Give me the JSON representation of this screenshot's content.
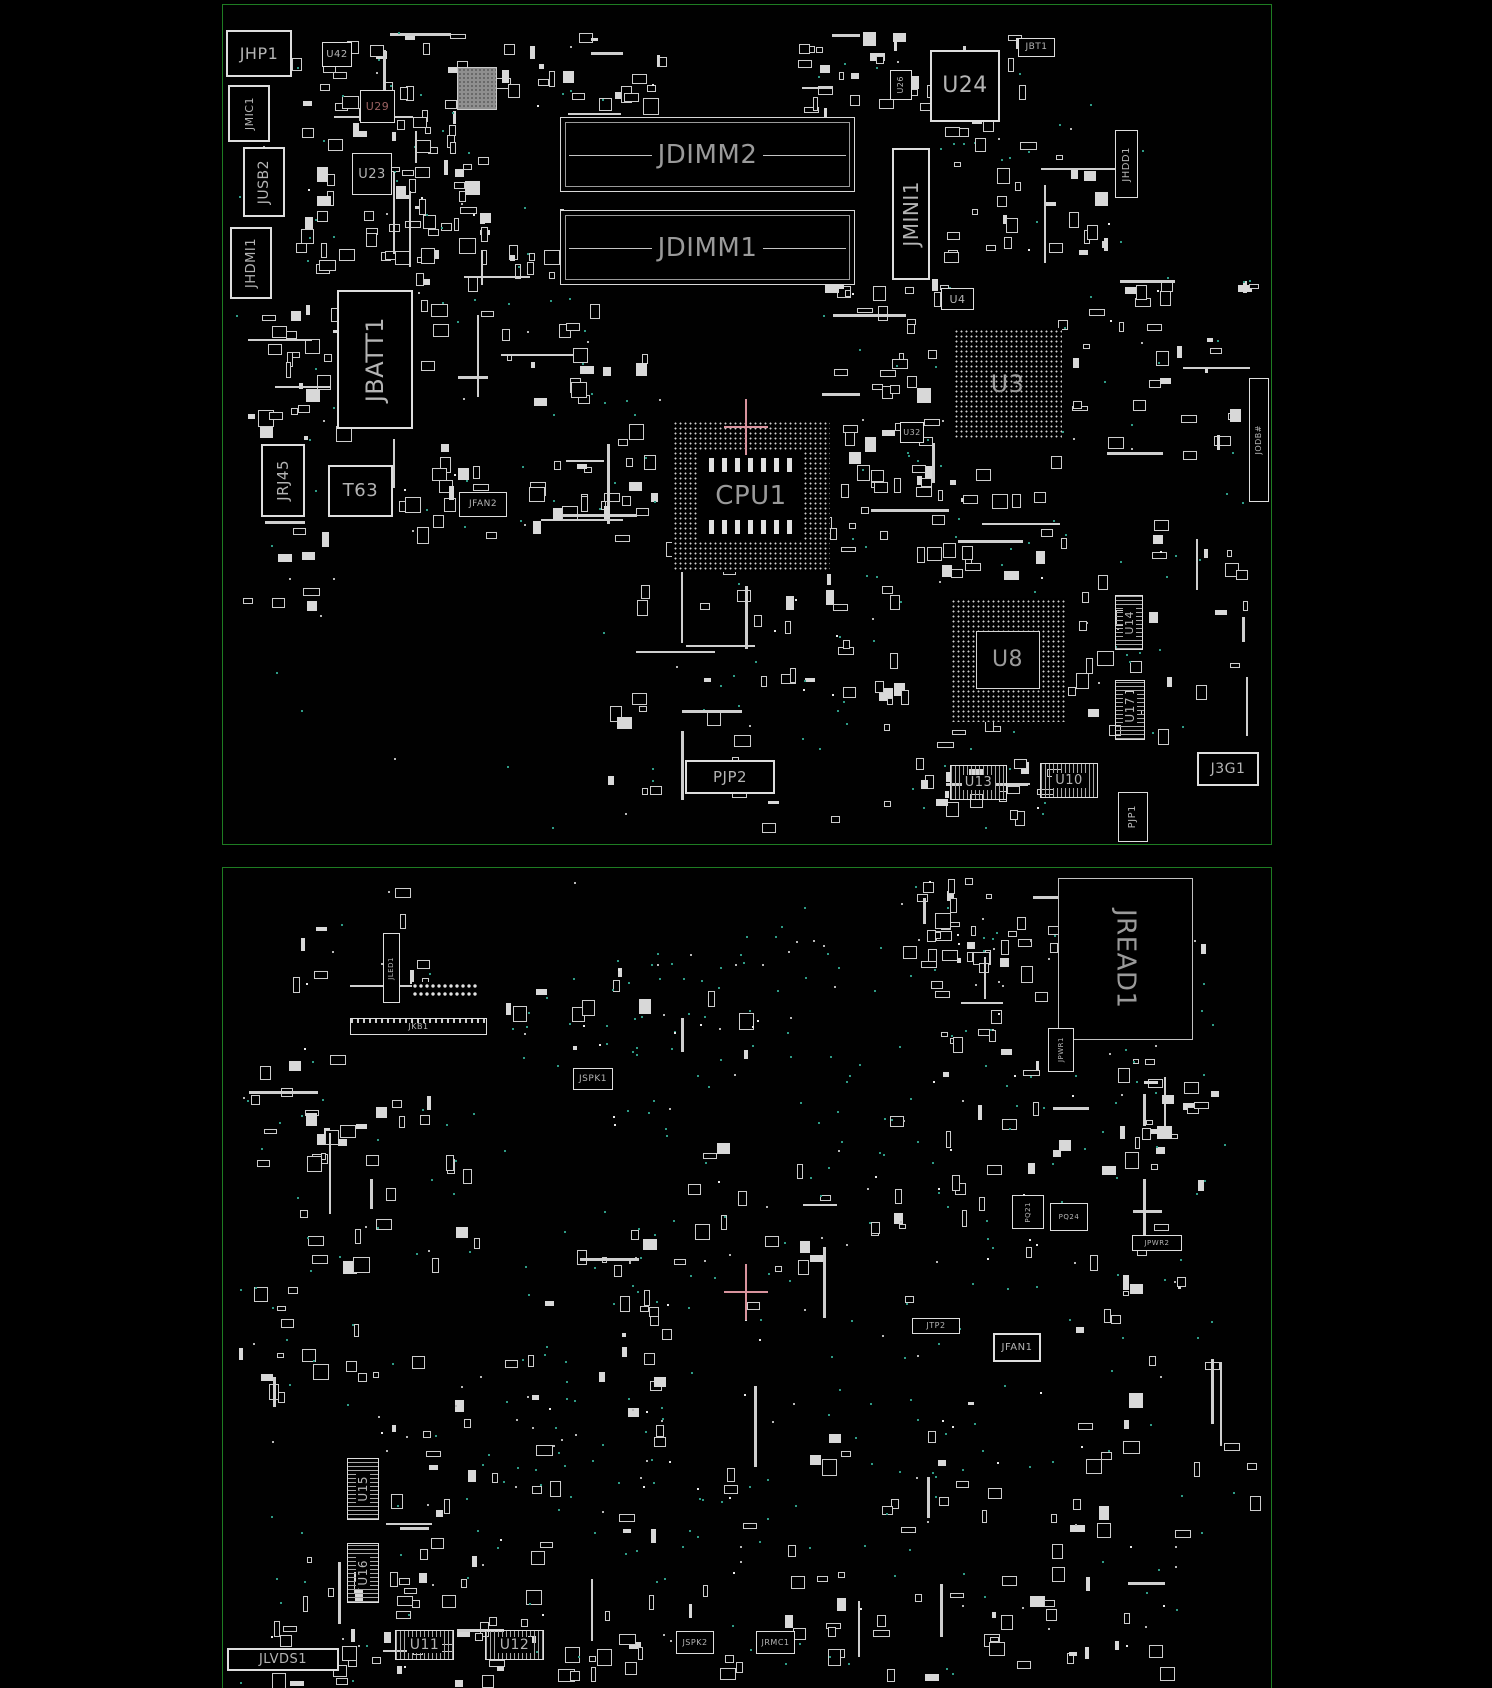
{
  "title": "Motherboard boardview - top and bottom side",
  "colors": {
    "background": "#000000",
    "board_border": "#1e7c22",
    "component_outline": "#dedede",
    "label": "#b4b4b4",
    "via_teal": "#2e9b86",
    "crosshair_pink": "#d8939d",
    "highlight_label_red": "#9b6262",
    "gray_chip_fill": "#8f8f8f"
  },
  "boards": {
    "top": {
      "name": "top-side-board"
    },
    "bottom": {
      "name": "bottom-side-board"
    }
  },
  "c": {
    "jhp1": {
      "label": "JHP1"
    },
    "jmic1": {
      "label": "JMIC1"
    },
    "jusb2": {
      "label": "JUSB2"
    },
    "jhdmi1": {
      "label": "JHDMI1"
    },
    "u42": {
      "label": "U42"
    },
    "u29": {
      "label": "U29"
    },
    "u23": {
      "label": "U23"
    },
    "u26": {
      "label": "U26"
    },
    "jbatt1": {
      "label": "JBATT1"
    },
    "jrj45": {
      "label": "JRJ45"
    },
    "t63": {
      "label": "T63"
    },
    "jfan2": {
      "label": "JFAN2"
    },
    "jdimm2": {
      "label": "JDIMM2"
    },
    "jdimm1": {
      "label": "JDIMM1"
    },
    "cpu1": {
      "label": "CPU1"
    },
    "u24": {
      "label": "U24"
    },
    "jbt1": {
      "label": "JBT1"
    },
    "jmini1": {
      "label": "JMINI1"
    },
    "u4": {
      "label": "U4"
    },
    "u3": {
      "label": "U3"
    },
    "u32": {
      "label": "U32"
    },
    "jhdd1": {
      "label": "JHDD1"
    },
    "jodb": {
      "label": "JODB#"
    },
    "u8": {
      "label": "U8"
    },
    "u14": {
      "label": "U14"
    },
    "u17": {
      "label": "U17"
    },
    "u13": {
      "label": "U13"
    },
    "u10": {
      "label": "U10"
    },
    "pjp2": {
      "label": "PJP2"
    },
    "j3g1": {
      "label": "J3G1"
    },
    "pjp1": {
      "label": "PJP1"
    },
    "jread1": {
      "label": "JREAD1"
    },
    "jled1": {
      "label": "JLED1"
    },
    "jkb1": {
      "label": "JKB1"
    },
    "jspk1": {
      "label": "JSPK1"
    },
    "jtp2": {
      "label": "JTP2"
    },
    "jfan1": {
      "label": "JFAN1"
    },
    "jpwr1": {
      "label": "JPWR1"
    },
    "jpwr2": {
      "label": "JPWR2"
    },
    "pq21": {
      "label": "PQ21"
    },
    "pq24": {
      "label": "PQ24"
    },
    "u15": {
      "label": "U15"
    },
    "u16": {
      "label": "U16"
    },
    "jlvds1": {
      "label": "JLVDS1"
    },
    "u11": {
      "label": "U11"
    },
    "u12": {
      "label": "U12"
    },
    "jspk2": {
      "label": "JSPK2"
    },
    "jrmc1": {
      "label": "JRMC1"
    }
  }
}
